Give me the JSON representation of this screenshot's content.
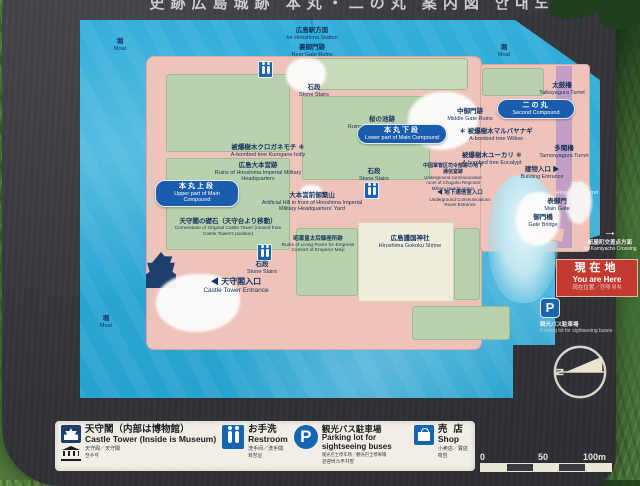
{
  "colors": {
    "board": "#333439",
    "water": "#2ba6d4",
    "ground_pink": "#eec3ba",
    "courtyard_green": "#b9d2ad",
    "shrine_cream": "#f0ecdb",
    "purple_strip": "#c39ec4",
    "accent_blue": "#1565b0",
    "pill_blue": "#1a5dad",
    "alert_red": "#c23a30",
    "legend_bg": "#f1eee6",
    "grass_green": "#557c3e"
  },
  "signboard": {
    "title_partial": "史跡広島城跡 本丸・二の丸 案内図 안내도"
  },
  "map": {
    "moat": {
      "jp": "堀",
      "en": "Moat"
    },
    "pills": {
      "upper": {
        "jp": "本丸上段",
        "en": "Upper part of Main Compound"
      },
      "lower": {
        "jp": "本丸下段",
        "en": "Lower part of Main Compound"
      },
      "second": {
        "jp": "二の丸",
        "en": "Second Compound"
      }
    },
    "labels": {
      "station": {
        "arrow": "↑",
        "jp": "広島駅方面",
        "en": "for Hiroshima Station"
      },
      "rear_gate": {
        "jp": "裏御門跡",
        "en": "Rear Gate Ruins"
      },
      "stairs_top": {
        "jp": "石段",
        "en": "Stone Stairs"
      },
      "pond": {
        "jp": "桜の池跡",
        "en": "Ruins of Sakurano-ike Pond"
      },
      "holly": {
        "jp": "被爆樹木クロガネモチ ✽",
        "en": "A-bombed tree Kurogane holly"
      },
      "hq": {
        "jp": "広島大本営跡",
        "en": "Ruins of Hiroshima Imperial Military Headquarters"
      },
      "hill": {
        "jp": "大本営前御築山",
        "en": "Artificial Hill in front of Hiroshima Imperial Military Headquarters' Yard"
      },
      "middle_gate": {
        "jp": "中御門跡",
        "en": "Middle Gate Ruins"
      },
      "taiko": {
        "jp": "太鼓櫓",
        "en": "Taikoyagura Turret"
      },
      "tamon": {
        "jp": "多聞櫓",
        "en": "Tamonyagura Turret"
      },
      "willow": {
        "jp": "✽ 被爆樹木マルバヤナギ",
        "en": "A-bombed tree Willow"
      },
      "eucalypt": {
        "jp": "被爆樹木ユーカリ ✽",
        "en": "A-bombed tree Eucalypt"
      },
      "ug_room": {
        "jp": "中国軍管区司令部跡の地下通信室跡",
        "en": "Underground communication room of Chugoku Regional Military Headquarters"
      },
      "ug_entrance": {
        "jp": "◀ 地下通信室入口",
        "en": "Underground Communications Room Entrance"
      },
      "stairs_mid": {
        "jp": "石段",
        "en": "Stone Stairs"
      },
      "building_entrance": {
        "jp": "建物入口 ▶",
        "en": "Building Entrance"
      },
      "hirayagura": {
        "jp": "平櫓",
        "en": "Hirayagura Turret"
      },
      "main_gate": {
        "jp": "表御門",
        "en": "Main Gate"
      },
      "gate_bridge": {
        "jp": "御門橋",
        "en": "Gate Bridge"
      },
      "kamiyacho": {
        "arrow": "→",
        "jp": "紙屋町交差点方面",
        "en": "for Kamiyacho Crossing"
      },
      "cornerstone": {
        "jp": "天守閣の礎石（天守台より移動）",
        "en": "Cornerstone of Original Castle Tower (moved from Castle Tower's position)"
      },
      "stairs_low": {
        "jp": "石段",
        "en": "Stone Stairs"
      },
      "tower_entrance": {
        "jp": "◀ 天守閣入口",
        "en": "Castle Tower Entrance"
      },
      "empress": {
        "jp": "昭憲皇太后御座所跡",
        "en": "Ruins of Living Room for Empress Consort of Emperor Meiji"
      },
      "shrine": {
        "jp": "広島護国神社",
        "en": "Hiroshima Gokoku Shrine"
      }
    },
    "you_are_here": {
      "jp": "現在地",
      "en": "You are Here",
      "sub": "现在位置／현재 위치"
    },
    "parking_callout": {
      "letter": "P",
      "jp": "観光バス駐車場",
      "en": "Parking lot for sightseeing buses"
    },
    "compass": {
      "letter": "N"
    },
    "scale": {
      "t0": "0",
      "t50": "50",
      "t100": "100m"
    }
  },
  "legend": {
    "items": [
      {
        "jp": "天守閣（内部は博物館）",
        "en": "Castle Tower (Inside is Museum)",
        "zh": "天守阁／天守閣",
        "ko": "천수각"
      },
      {
        "jp": "お手洗",
        "en": "Restroom",
        "zh": "洗手间／洗手間",
        "ko": "화장실"
      },
      {
        "jp": "観光バス駐車場",
        "en": "Parking lot for sightseeing buses",
        "zh": "观光巴士停车场／觀光巴士停車場",
        "ko": "관광버스주차장"
      },
      {
        "jp": "売店",
        "en": "Shop",
        "zh": "小卖店／賣店",
        "ko": "매점"
      }
    ],
    "parking_letter": "P"
  }
}
